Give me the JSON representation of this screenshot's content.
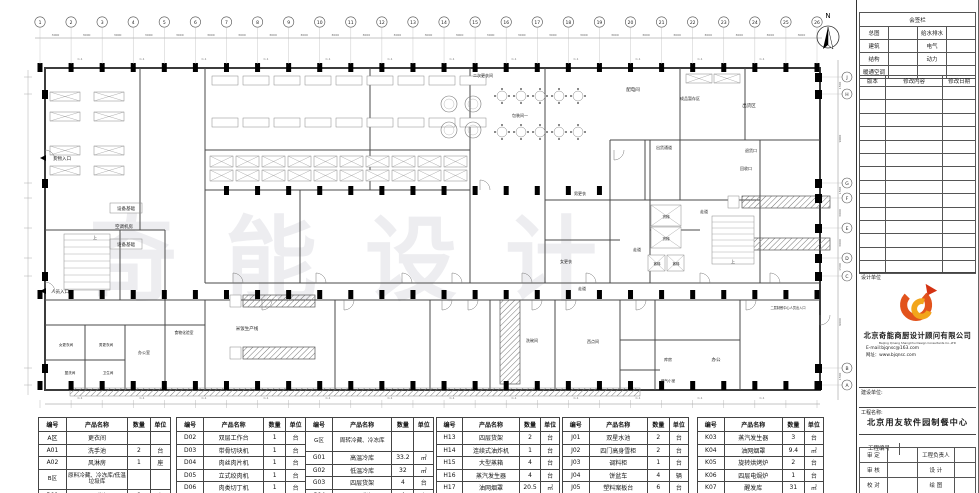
{
  "sheet": {
    "watermark": "奇能设计",
    "north_label": "N",
    "section_marker": "C-1"
  },
  "grid": {
    "numbers": [
      "1",
      "2",
      "3",
      "4",
      "5",
      "6",
      "7",
      "8",
      "9",
      "10",
      "11",
      "12",
      "13",
      "14",
      "15",
      "16",
      "17",
      "18",
      "19",
      "20",
      "21",
      "22",
      "23",
      "24",
      "25",
      "26"
    ],
    "span_dim": "3000",
    "letters_top_to_bottom": [
      "J",
      "H",
      "G",
      "F",
      "E",
      "D",
      "C",
      "B",
      "A"
    ],
    "right_dims": [
      "1500",
      "9000",
      "1500",
      "3000",
      "3000",
      "1500",
      "9000",
      "1500"
    ]
  },
  "floor_plan": {
    "rooms": [
      {
        "label": "货物入口",
        "x": 62,
        "y": 160,
        "s": 4.5
      },
      {
        "label": "人员入口",
        "x": 60,
        "y": 293,
        "s": 4.5
      },
      {
        "label": "设备基础",
        "x": 126,
        "y": 210,
        "s": 4.5,
        "boxed": true
      },
      {
        "label": "空调机房",
        "x": 124,
        "y": 228,
        "s": 4.5
      },
      {
        "label": "设备基础",
        "x": 126,
        "y": 246,
        "s": 4.5,
        "boxed": true
      },
      {
        "label": "二次更衣间",
        "x": 483,
        "y": 77,
        "s": 4
      },
      {
        "label": "包装间一",
        "x": 520,
        "y": 117,
        "s": 4
      },
      {
        "label": "配电间",
        "x": 633,
        "y": 91,
        "s": 4.5
      },
      {
        "label": "成品暂存区",
        "x": 690,
        "y": 100,
        "s": 4
      },
      {
        "label": "出货区",
        "x": 749,
        "y": 107,
        "s": 4.5
      },
      {
        "label": "出货通道",
        "x": 664,
        "y": 149,
        "s": 4
      },
      {
        "label": "退货口",
        "x": 751,
        "y": 152,
        "s": 4
      },
      {
        "label": "回收口",
        "x": 746,
        "y": 170,
        "s": 4
      },
      {
        "label": "男更衣",
        "x": 580,
        "y": 195,
        "s": 4
      },
      {
        "label": "女更衣",
        "x": 566,
        "y": 263,
        "s": 4
      },
      {
        "label": "走道",
        "x": 582,
        "y": 290,
        "s": 4
      },
      {
        "label": "走道",
        "x": 704,
        "y": 213,
        "s": 4
      },
      {
        "label": "走道",
        "x": 637,
        "y": 251,
        "s": 4
      },
      {
        "label": "货梯",
        "x": 666,
        "y": 218,
        "s": 3.6
      },
      {
        "label": "货梯",
        "x": 666,
        "y": 240,
        "s": 3.6
      },
      {
        "label": "客梯",
        "x": 657,
        "y": 265,
        "s": 3.4
      },
      {
        "label": "客梯",
        "x": 676,
        "y": 265,
        "s": 3.4
      },
      {
        "label": "上",
        "x": 733,
        "y": 263,
        "s": 4
      },
      {
        "label": "上",
        "x": 95,
        "y": 239,
        "s": 4
      },
      {
        "label": "米饭生产线",
        "x": 247,
        "y": 330,
        "s": 4.5
      },
      {
        "label": "食物化验室",
        "x": 184,
        "y": 334,
        "s": 3.8
      },
      {
        "label": "办公室",
        "x": 144,
        "y": 354,
        "s": 4
      },
      {
        "label": "女更衣间",
        "x": 66,
        "y": 346,
        "s": 3.6
      },
      {
        "label": "男更衣间",
        "x": 106,
        "y": 346,
        "s": 3.6
      },
      {
        "label": "盥洗间",
        "x": 70,
        "y": 374,
        "s": 3.6
      },
      {
        "label": "卫生间",
        "x": 108,
        "y": 374,
        "s": 3.6
      },
      {
        "label": "洗碗间",
        "x": 532,
        "y": 342,
        "s": 4
      },
      {
        "label": "西点间",
        "x": 593,
        "y": 343,
        "s": 4
      },
      {
        "label": "库房",
        "x": 668,
        "y": 361,
        "s": 4
      },
      {
        "label": "办公",
        "x": 716,
        "y": 361,
        "s": 4.5
      },
      {
        "label": "燃气小室",
        "x": 668,
        "y": 382,
        "s": 3.6
      },
      {
        "label": "二层制餐中心人员出入口",
        "x": 788,
        "y": 309,
        "s": 3.2
      }
    ]
  },
  "title_block": {
    "sign_header": "会签栏",
    "sign_rows": [
      [
        "总图",
        "给水排水"
      ],
      [
        "建筑",
        "电气"
      ],
      [
        "结构",
        "动力"
      ],
      [
        "暖通空调",
        ""
      ]
    ],
    "revision_header": [
      "版本",
      "修改内容",
      "修改日期"
    ],
    "design_unit_label": "设计单位",
    "company_cn": "北京奇能商厨设计顾问有限公司",
    "company_en": "Beijing Qineng ShangChu Design Consultants Co.,LTD",
    "email": "E-mail:bjqnsc@163.com",
    "website": "网址：www.bjqnsc.com",
    "build_unit_label": "建设单位:",
    "project_name_label": "工程名称:",
    "project_name": "北京用友软件园制餐中心",
    "project_no_label": "工程编号",
    "sign_fields": [
      [
        "审  定",
        "工程负责人"
      ],
      [
        "审  核",
        "设  计"
      ],
      [
        "校  对",
        "绘  图"
      ]
    ]
  },
  "equipment_tables": {
    "headers": [
      "编号",
      "产品名称",
      "数量",
      "单位"
    ],
    "tables": [
      {
        "tall": [
          3
        ],
        "rows": [
          [
            "A区",
            "更衣间",
            "",
            ""
          ],
          [
            "A01",
            "洗手池",
            "2",
            "台"
          ],
          [
            "A02",
            "风淋房",
            "1",
            "座"
          ],
          [
            "B区",
            "原料冷藏、冷冻库/低温垃圾库",
            "",
            ""
          ],
          [
            "B01",
            "四层货架",
            "8",
            "台"
          ]
        ]
      },
      {
        "tall": [],
        "rows": [
          [
            "D02",
            "双层工作台",
            "1",
            "台"
          ],
          [
            "D03",
            "带骨切块机",
            "1",
            "台"
          ],
          [
            "D04",
            "肉丝肉片机",
            "1",
            "台"
          ],
          [
            "D05",
            "立式绞肉机",
            "1",
            "台"
          ],
          [
            "D06",
            "肉类切丁机",
            "1",
            "台"
          ],
          [
            "",
            "",
            "",
            ""
          ]
        ]
      },
      {
        "tall": [
          0
        ],
        "rows": [
          [
            "G区",
            "周转冷藏、冷冻库",
            "",
            ""
          ],
          [
            "G01",
            "高温冷库",
            "33.2",
            "㎡"
          ],
          [
            "G02",
            "低温冷库",
            "32",
            "㎡"
          ],
          [
            "G03",
            "四层货架",
            "4",
            "台"
          ],
          [
            "G04",
            "四层货架",
            "4",
            "台"
          ]
        ]
      },
      {
        "tall": [],
        "rows": [
          [
            "H13",
            "四层货架",
            "2",
            "台"
          ],
          [
            "H14",
            "连续式油炸机",
            "1",
            "台"
          ],
          [
            "H15",
            "大型蒸箱",
            "4",
            "台"
          ],
          [
            "H16",
            "蒸汽发生器",
            "4",
            "台"
          ],
          [
            "H17",
            "油网烟罩",
            "20.5",
            "㎡"
          ],
          [
            "H18",
            "醒发箱",
            "2",
            "台"
          ]
        ]
      },
      {
        "tall": [],
        "rows": [
          [
            "J01",
            "双星水池",
            "2",
            "台"
          ],
          [
            "J02",
            "四门高身雪柜",
            "2",
            "台"
          ],
          [
            "J03",
            "调料柜",
            "1",
            "台"
          ],
          [
            "J04",
            "饼盆车",
            "4",
            "辆"
          ],
          [
            "J05",
            "塑料案板台",
            "6",
            "台"
          ],
          [
            "J06",
            "面粉车",
            "10",
            "台"
          ]
        ]
      },
      {
        "tall": [],
        "rows": [
          [
            "K03",
            "蒸汽发生器",
            "3",
            "台"
          ],
          [
            "K04",
            "油网烟罩",
            "9.4",
            "㎡"
          ],
          [
            "K05",
            "旋转烘烤炉",
            "2",
            "台"
          ],
          [
            "K06",
            "四层电焗炉",
            "1",
            "台"
          ],
          [
            "K07",
            "醒发库",
            "31",
            "㎡"
          ],
          [
            "K08",
            "四层货架",
            "5",
            "台"
          ]
        ]
      }
    ]
  }
}
